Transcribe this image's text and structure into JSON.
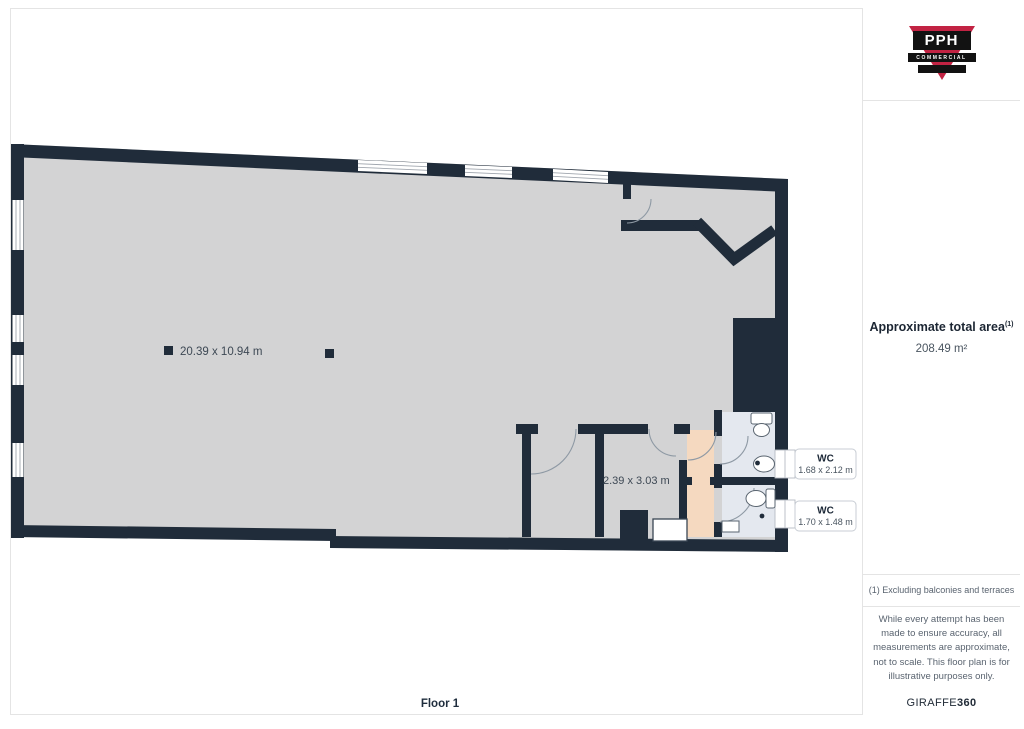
{
  "plan": {
    "floor_label": "Floor 1",
    "main_room_dims": "20.39 x 10.94 m",
    "inner_room_dims": "2.39 x 3.03 m",
    "wc1": {
      "label": "WC",
      "dims": "1.68 x 2.12 m"
    },
    "wc2": {
      "label": "WC",
      "dims": "1.70 x 1.48 m"
    },
    "colors": {
      "wall": "#202c3a",
      "floor": "#d3d3d4",
      "corridor": "#f5d9c0",
      "wc_floor": "#e4e8ef",
      "window": "#ffffff",
      "door_arc": "#8e99a4"
    }
  },
  "sidebar": {
    "logo": {
      "acronym": "PPH",
      "word": "COMMERCIAL",
      "accent": "#c22343"
    },
    "area_title": "Approximate total area",
    "area_superscript": "(1)",
    "area_value": "208.49 m²",
    "footnote": "(1) Excluding balconies and terraces",
    "disclaimer": "While every attempt has been made to ensure accuracy, all measurements are approximate, not to scale. This floor plan is for illustrative purposes only.",
    "brand_name": "GIRAFFE",
    "brand_suffix": "360"
  }
}
